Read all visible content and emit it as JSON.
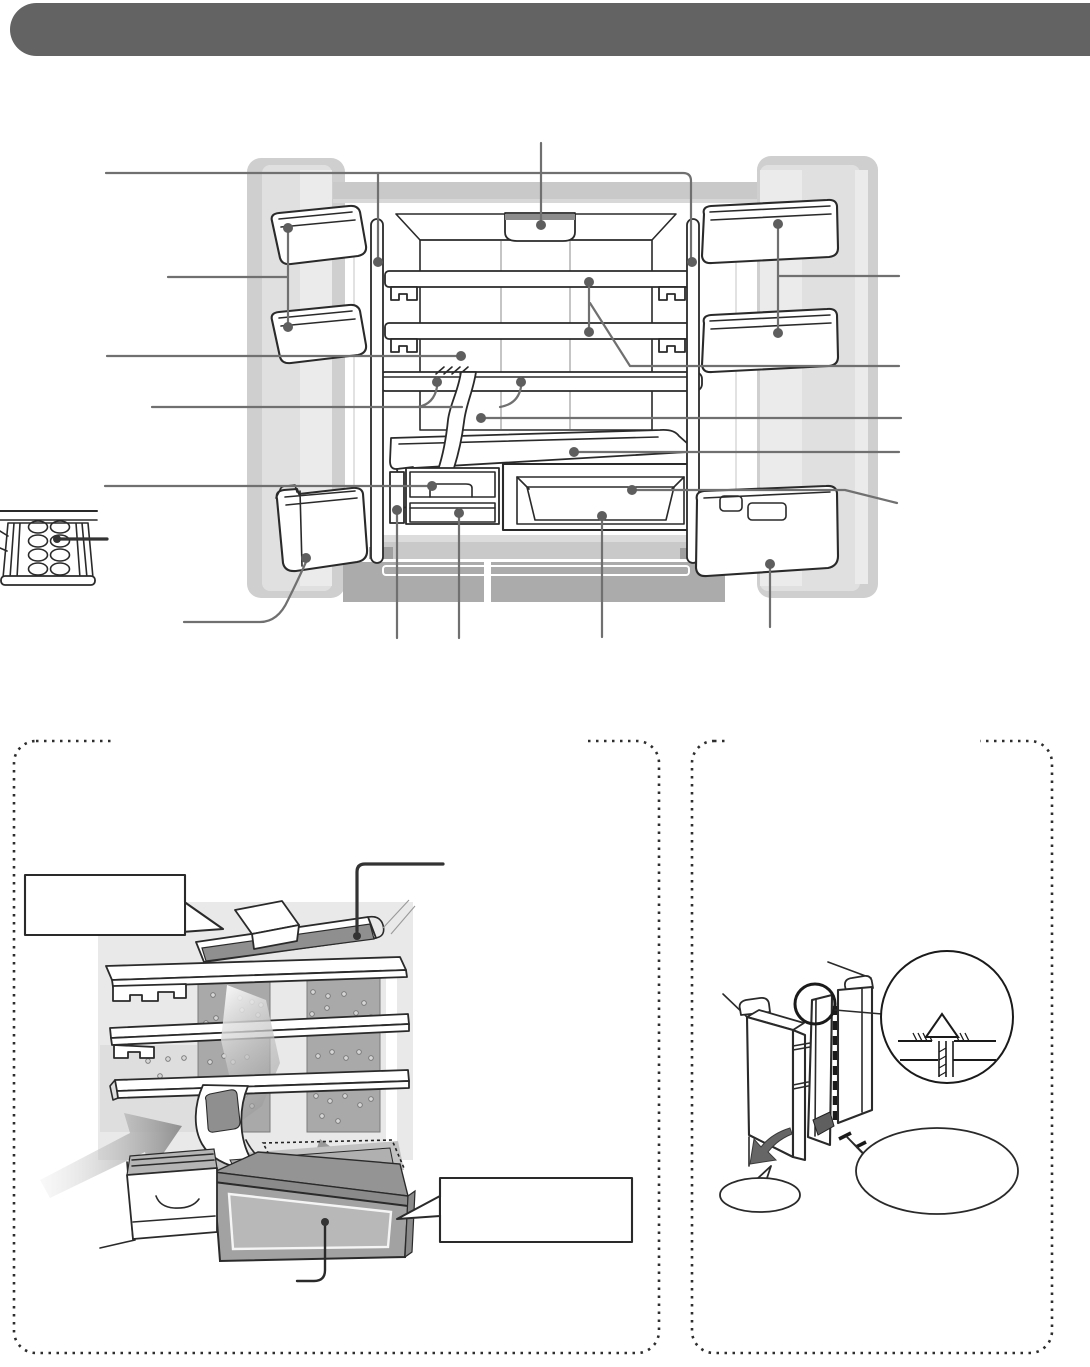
{
  "header": {
    "bar_color": "#636363",
    "title_text": ""
  },
  "palette": {
    "bg": "#ffffff",
    "header_bar": "#636363",
    "outline": "#2a2a2a",
    "callout": "#707070",
    "dot": "#5e5e5e",
    "thick": "#333333",
    "door_base": "#cfcfcf",
    "door_mid": "#e0e0e0",
    "door_light": "#ebebeb",
    "top_band": "#c9c9c9",
    "ceiling": "#f2f2f2",
    "lamp_strip": "#8c8c8c",
    "wall_top": "#dfdfdf",
    "wall_bot": "#cacaca",
    "wall_seam": "#b2b2b2",
    "glass": "#ededed",
    "base_light": "#dcdcdc",
    "base_mid": "#c9c9c9",
    "base_dark": "#ababab",
    "base_cap": "#9f9f9f",
    "scene_wall": "#e9e9e9",
    "panel": "#a9a9a9",
    "panel_lt": "#dedede",
    "hole_fill": "#d6d6d6",
    "hole_ring": "#767676",
    "duct_dark": "#8f8f8f",
    "case_rim": "#8a8a8a",
    "case_top": "#949494",
    "case_front": "#a2a2a2",
    "case_win": "#b8b8b8",
    "cavity": "#b0b0b0",
    "floor_gray": "#c2c2c2",
    "arrow_gray": "#9a9a9a",
    "swing": "#666666",
    "cam": "#5f5f5f",
    "drawer_int": "#b5b5b5"
  },
  "figures": {
    "main_diagram": "refrigerator-interior-with-open-doors",
    "egg_tray": "egg-tray-detail",
    "box_a": "cooling-airflow-panel",
    "box_b": "door-pillar-panel"
  },
  "callouts": {
    "dot_radius": 5,
    "dots": [
      {
        "part": "left-pillar-cover",
        "x": 378,
        "y": 262
      },
      {
        "part": "right-pillar-cover",
        "x": 692,
        "y": 262
      },
      {
        "part": "led-lamp",
        "x": 541,
        "y": 225
      },
      {
        "part": "left-door-bin-upper",
        "x": 288,
        "y": 228
      },
      {
        "part": "left-door-bin-lower",
        "x": 288,
        "y": 327
      },
      {
        "part": "right-door-bin-upper",
        "x": 778,
        "y": 224
      },
      {
        "part": "right-door-bin-lower",
        "x": 778,
        "y": 333
      },
      {
        "part": "back-wall",
        "x": 461,
        "y": 356
      },
      {
        "part": "shelf-upper",
        "x": 589,
        "y": 282
      },
      {
        "part": "shelf-lower",
        "x": 589,
        "y": 332
      },
      {
        "part": "sliding-shelf-left",
        "x": 437,
        "y": 382
      },
      {
        "part": "sliding-shelf-right",
        "x": 521,
        "y": 382
      },
      {
        "part": "water-tube",
        "x": 481,
        "y": 418
      },
      {
        "part": "chilled-room-top",
        "x": 574,
        "y": 452
      },
      {
        "part": "ice-drawer",
        "x": 432,
        "y": 486
      },
      {
        "part": "partition-panel",
        "x": 397,
        "y": 510
      },
      {
        "part": "small-drawer",
        "x": 459,
        "y": 513
      },
      {
        "part": "case-frame",
        "x": 632,
        "y": 490
      },
      {
        "part": "case-window",
        "x": 602,
        "y": 516
      },
      {
        "part": "left-lower-bin",
        "x": 306,
        "y": 558
      },
      {
        "part": "right-lower-bin",
        "x": 770,
        "y": 564
      }
    ],
    "dark_dots": [
      {
        "part": "egg-pocket",
        "x": 57,
        "y": 539,
        "r": 4
      },
      {
        "part": "airflow-top-duct",
        "x": 357,
        "y": 936,
        "r": 4
      },
      {
        "part": "airflow-chilled-case",
        "x": 325,
        "y": 1222,
        "r": 4
      }
    ]
  },
  "decor": {
    "panel_holes": [
      [
        213,
        995
      ],
      [
        240,
        998
      ],
      [
        252,
        1002
      ],
      [
        261,
        1005
      ],
      [
        242,
        1010
      ],
      [
        258,
        1015
      ],
      [
        216,
        1018
      ],
      [
        206,
        1023
      ],
      [
        224,
        1056
      ],
      [
        210,
        1062
      ],
      [
        233,
        1062
      ],
      [
        247,
        1057
      ],
      [
        216,
        1092
      ],
      [
        229,
        1099
      ],
      [
        245,
        1095
      ],
      [
        252,
        1106
      ],
      [
        236,
        1113
      ],
      [
        222,
        1121
      ],
      [
        313,
        992
      ],
      [
        328,
        996
      ],
      [
        344,
        994
      ],
      [
        364,
        1003
      ],
      [
        327,
        1008
      ],
      [
        312,
        1014
      ],
      [
        356,
        1013
      ],
      [
        371,
        1017
      ],
      [
        318,
        1056
      ],
      [
        332,
        1052
      ],
      [
        346,
        1058
      ],
      [
        359,
        1052
      ],
      [
        371,
        1058
      ],
      [
        316,
        1096
      ],
      [
        330,
        1101
      ],
      [
        345,
        1096
      ],
      [
        360,
        1105
      ],
      [
        371,
        1099
      ],
      [
        322,
        1116
      ],
      [
        338,
        1121
      ],
      [
        148,
        1061
      ],
      [
        168,
        1059
      ],
      [
        184,
        1058
      ],
      [
        160,
        1076
      ],
      [
        148,
        1091
      ],
      [
        173,
        1088
      ]
    ]
  }
}
